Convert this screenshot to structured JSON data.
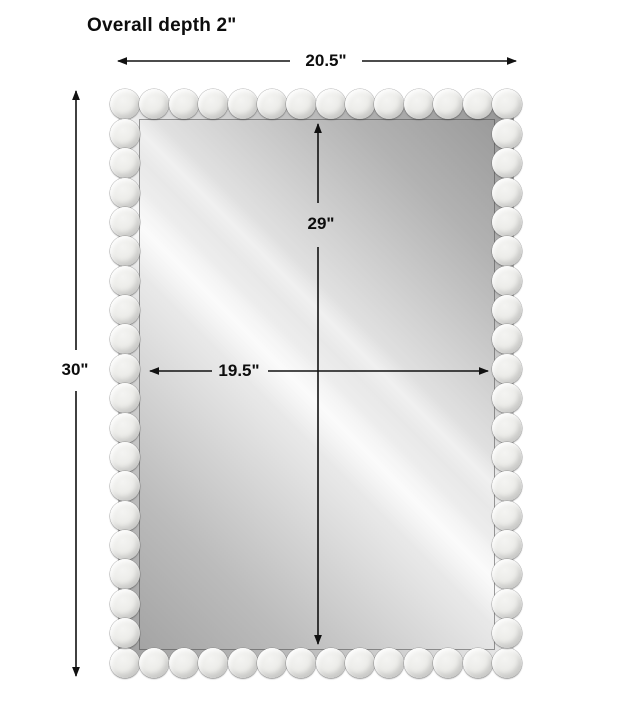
{
  "title": "Overall depth 2\"",
  "dimensions": {
    "overall_width_label": "20.5\"",
    "overall_height_label": "30\"",
    "mirror_height_label": "29\"",
    "mirror_width_label": "19.5\""
  },
  "figure": {
    "name": "beaded-frame-rectangular-mirror",
    "line_color": "#111111",
    "bead_color": "#ececea",
    "glass_gray_dark": "#989898",
    "glass_gray_light": "#f0f0f0",
    "beads": {
      "top_row": 14,
      "bottom_row": 14,
      "left_column": 18,
      "right_column": 18
    }
  }
}
